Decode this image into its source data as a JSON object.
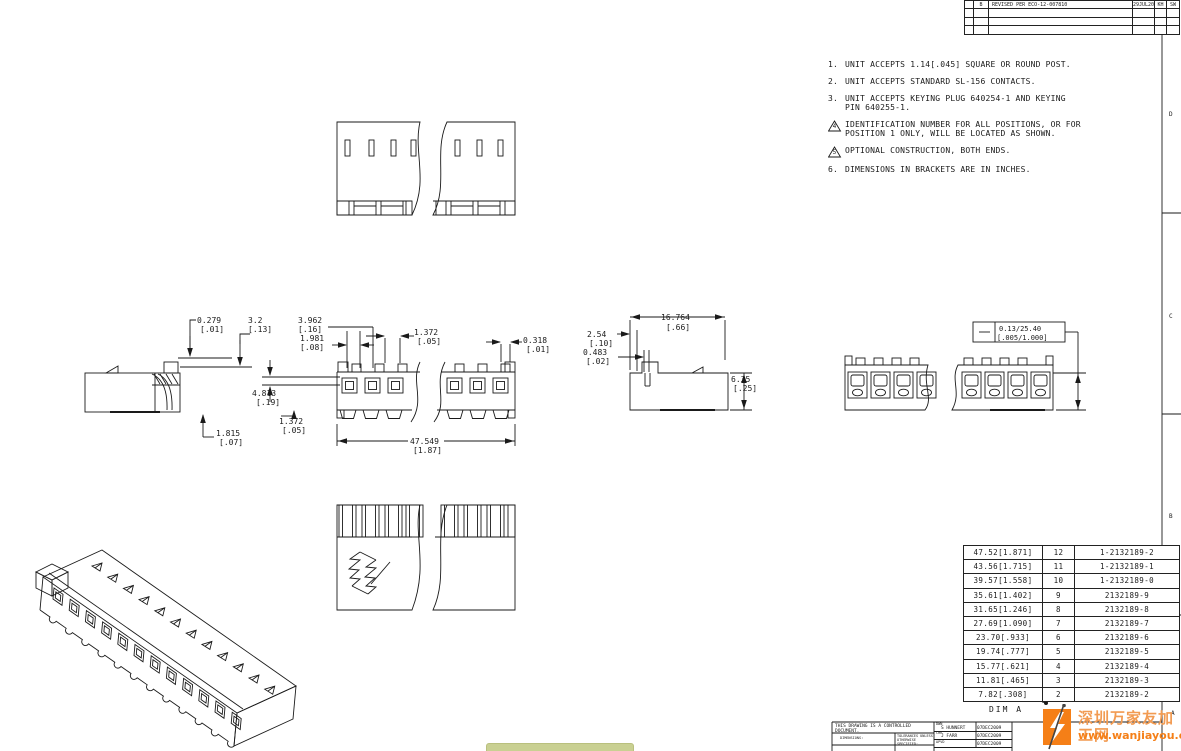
{
  "sheet": {
    "zones": {
      "d": "D",
      "c": "C",
      "b": "B",
      "a": "A"
    }
  },
  "revision_table": {
    "rows": [
      {
        "rev": "B",
        "description": "REVISED PER ECO-12-007810",
        "date": "29JUL2012",
        "drwn": "KH",
        "apvd": "SW"
      }
    ]
  },
  "notes": [
    {
      "num": "1.",
      "text": "UNIT ACCEPTS 1.14[.045] SQUARE OR ROUND POST."
    },
    {
      "num": "2.",
      "text": "UNIT ACCEPTS STANDARD SL-156 CONTACTS."
    },
    {
      "num": "3.",
      "text": "UNIT ACCEPTS KEYING PLUG 640254-1 AND KEYING PIN 640255-1."
    },
    {
      "num": "4",
      "text": "IDENTIFICATION NUMBER FOR ALL POSITIONS, OR FOR POSITION 1 ONLY, WILL BE LOCATED AS SHOWN."
    },
    {
      "num": "5",
      "text": "OPTIONAL CONSTRUCTION, BOTH ENDS."
    },
    {
      "num": "6.",
      "text": "DIMENSIONS IN BRACKETS ARE IN INCHES."
    }
  ],
  "dimensions": {
    "d0279": {
      "l1": "0.279",
      "l2": "[.01]"
    },
    "d32": {
      "l1": "3.2",
      "l2": "[.13]"
    },
    "d3962": {
      "l1": "3.962",
      "l2": "[.16]"
    },
    "d1981": {
      "l1": "1.981",
      "l2": "[.08]"
    },
    "d1372t": {
      "l1": "1.372",
      "l2": "[.05]"
    },
    "d0318": {
      "l1": "0.318",
      "l2": "[.01]"
    },
    "d4813": {
      "l1": "4.813",
      "l2": "[.19]"
    },
    "d1372b": {
      "l1": "1.372",
      "l2": "[.05]"
    },
    "d1815": {
      "l1": "1.815",
      "l2": "[.07]"
    },
    "d47549": {
      "l1": "47.549",
      "l2": "[1.87]"
    },
    "d254": {
      "l1": "2.54",
      "l2": "[.10]"
    },
    "d16764": {
      "l1": "16.764",
      "l2": "[.66]"
    },
    "d0483": {
      "l1": "0.483",
      "l2": "[.02]"
    },
    "d635": {
      "l1": "6.35",
      "l2": "[.25]"
    }
  },
  "callout": {
    "symbol": "—",
    "mm": "0.13/25.40",
    "in": "[.005/1.000]"
  },
  "parts_table": {
    "rows": [
      {
        "dim": "47.52[1.871]",
        "pos": "12",
        "part": "1-2132189-2"
      },
      {
        "dim": "43.56[1.715]",
        "pos": "11",
        "part": "1-2132189-1"
      },
      {
        "dim": "39.57[1.558]",
        "pos": "10",
        "part": "1-2132189-0"
      },
      {
        "dim": "35.61[1.402]",
        "pos": "9",
        "part": "2132189-9"
      },
      {
        "dim": "31.65[1.246]",
        "pos": "8",
        "part": "2132189-8"
      },
      {
        "dim": "27.69[1.090]",
        "pos": "7",
        "part": "2132189-7"
      },
      {
        "dim": "23.70[.933]",
        "pos": "6",
        "part": "2132189-6"
      },
      {
        "dim": "19.74[.777]",
        "pos": "5",
        "part": "2132189-5"
      },
      {
        "dim": "15.77[.621]",
        "pos": "4",
        "part": "2132189-4"
      },
      {
        "dim": "11.81[.465]",
        "pos": "3",
        "part": "2132189-3"
      },
      {
        "dim": "7.82[.308]",
        "pos": "2",
        "part": "2132189-2"
      }
    ],
    "footer_label": "DIM A"
  },
  "title_block": {
    "controlled": "THIS DRAWING IS A CONTROLLED DOCUMENT.",
    "dimensions_label": "DIMENSIONS:",
    "tolerances_label": "TOLERANCES UNLESS OTHERWISE SPECIFIED:",
    "dwn_label": "DWN",
    "dwn_name": "S HUNNERT",
    "dwn_date": "07DEC2009",
    "chk_label": "CHK",
    "chk_name": "J FARR",
    "chk_date": "07DEC2009",
    "apvd_label": "APVD",
    "apvd_date": "07DEC2009"
  },
  "watermark": {
    "site_name": "深圳万家友加工网",
    "site_url": "www.wanjiayou.com"
  }
}
